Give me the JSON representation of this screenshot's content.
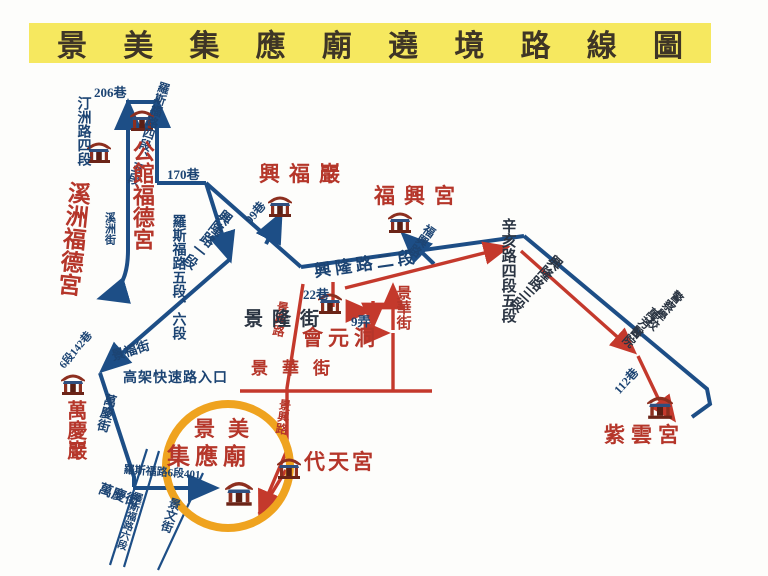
{
  "title": {
    "text": "景美集應廟遶境路線圖"
  },
  "colors": {
    "banner_bg": "#f6e85f",
    "banner_text": "#3e3526",
    "route_blue": "#1d4e86",
    "route_red": "#c4392c",
    "label_navy": "#1c4473",
    "label_dark": "#2a3442",
    "temple_red": "#b5362a",
    "highlight_orange": "#efa31f"
  },
  "highlight_circle": {
    "cx": 228,
    "cy": 466,
    "r": 62
  },
  "temples": [
    {
      "name": "公館福德宮",
      "icon": {
        "x": 129,
        "y": 108,
        "size": 26
      },
      "labels": [
        {
          "text": "公館福德宮",
          "x": 130,
          "y": 140,
          "size": 22,
          "vertical": true
        }
      ]
    },
    {
      "name": "溪洲福德宮",
      "icon": {
        "x": 86,
        "y": 140,
        "size": 26
      },
      "labels": [
        {
          "text": "溪洲福德宮",
          "x": 66,
          "y": 180,
          "size": 23,
          "vertical": true,
          "rotate": 6
        }
      ]
    },
    {
      "name": "興福巖",
      "icon": {
        "x": 267,
        "y": 194,
        "size": 26
      },
      "labels": [
        {
          "text": "興福巖",
          "x": 259,
          "y": 164,
          "size": 21,
          "ls": 9
        }
      ]
    },
    {
      "name": "福興宮",
      "icon": {
        "x": 387,
        "y": 210,
        "size": 26
      },
      "labels": [
        {
          "text": "福興宮",
          "x": 374,
          "y": 186,
          "size": 21,
          "ls": 9
        }
      ]
    },
    {
      "name": "會元洞",
      "icon": {
        "x": 317,
        "y": 291,
        "size": 26
      },
      "labels": [
        {
          "text": "會元洞",
          "x": 302,
          "y": 328,
          "size": 21,
          "ls": 5
        }
      ]
    },
    {
      "name": "萬慶巖",
      "icon": {
        "x": 60,
        "y": 372,
        "size": 26
      },
      "labels": [
        {
          "text": "萬慶巖",
          "x": 64,
          "y": 400,
          "size": 20,
          "vertical": true
        }
      ]
    },
    {
      "name": "紫雲宮",
      "icon": {
        "x": 646,
        "y": 394,
        "size": 28
      },
      "labels": [
        {
          "text": "紫雲宮",
          "x": 604,
          "y": 425,
          "size": 21,
          "ls": 6
        }
      ]
    },
    {
      "name": "代天宮",
      "icon": {
        "x": 276,
        "y": 456,
        "size": 26
      },
      "labels": [
        {
          "text": "代天宮",
          "x": 304,
          "y": 452,
          "size": 21,
          "ls": 3
        }
      ]
    },
    {
      "name": "景美集應廟",
      "icon": {
        "x": 224,
        "y": 479,
        "size": 30
      },
      "labels": [
        {
          "text": "景美",
          "x": 194,
          "y": 419,
          "size": 21,
          "ls": 13
        },
        {
          "text": "集應廟",
          "x": 167,
          "y": 445,
          "size": 23,
          "ls": 5
        }
      ]
    }
  ],
  "road_labels": [
    {
      "text": "206巷",
      "x": 94,
      "y": 86,
      "size": 13
    },
    {
      "text": "汀洲路四段",
      "x": 75,
      "y": 96,
      "size": 14,
      "vertical": true
    },
    {
      "text": "羅斯福路四段、五段",
      "x": 159,
      "y": 80,
      "size": 12,
      "vertical": true,
      "rotate": 18
    },
    {
      "text": "170巷",
      "x": 167,
      "y": 168,
      "size": 13
    },
    {
      "text": "溪洲街",
      "x": 103,
      "y": 212,
      "size": 11,
      "vertical": true
    },
    {
      "text": "羅斯福路五段、六段",
      "x": 170,
      "y": 214,
      "size": 14,
      "vertical": true
    },
    {
      "text": "興隆路一段",
      "x": 222,
      "y": 206,
      "size": 14,
      "vertical": true,
      "rotate": 38
    },
    {
      "text": "99巷",
      "x": 243,
      "y": 218,
      "size": 12,
      "rotate": -50
    },
    {
      "text": "興隆路二段",
      "x": 313,
      "y": 263,
      "size": 17,
      "ls": 4,
      "rotate": -8
    },
    {
      "text": "福興路",
      "x": 427,
      "y": 222,
      "size": 12,
      "vertical": true,
      "rotate": 35
    },
    {
      "text": "辛亥路四段五段",
      "x": 499,
      "y": 218,
      "size": 15,
      "vertical": true,
      "color": "dark"
    },
    {
      "text": "興隆路三段",
      "x": 553,
      "y": 251,
      "size": 14,
      "vertical": true,
      "rotate": 42,
      "color": "dark"
    },
    {
      "text": "警察學校",
      "x": 676,
      "y": 288,
      "size": 12,
      "vertical": true,
      "rotate": 42,
      "wrap": 2,
      "color": "dark"
    },
    {
      "text": "萬芳醫院",
      "x": 652,
      "y": 305,
      "size": 12,
      "vertical": true,
      "rotate": 42,
      "wrap": 2,
      "color": "dark"
    },
    {
      "text": "112巷",
      "x": 612,
      "y": 388,
      "size": 12,
      "rotate": -48
    },
    {
      "text": "22巷",
      "x": 303,
      "y": 288,
      "size": 13
    },
    {
      "text": "9弄",
      "x": 351,
      "y": 315,
      "size": 13
    },
    {
      "text": "景華街",
      "x": 394,
      "y": 285,
      "size": 15,
      "vertical": true,
      "color": "red"
    },
    {
      "text": "景華街",
      "x": 251,
      "y": 360,
      "size": 17,
      "ls": 14,
      "color": "red"
    },
    {
      "text": "景興路",
      "x": 277,
      "y": 300,
      "size": 12,
      "vertical": true,
      "rotate": 10,
      "color": "red"
    },
    {
      "text": "景興路",
      "x": 279,
      "y": 398,
      "size": 12,
      "vertical": true,
      "rotate": 8,
      "color": "red"
    },
    {
      "text": "景隆街",
      "x": 244,
      "y": 310,
      "size": 19,
      "ls": 9,
      "color": "dark"
    },
    {
      "text": "景福街",
      "x": 110,
      "y": 350,
      "size": 13,
      "rotate": -17
    },
    {
      "text": "6段142巷",
      "x": 58,
      "y": 364,
      "size": 11,
      "rotate": -50
    },
    {
      "text": "高架快速路入口",
      "x": 123,
      "y": 372,
      "size": 14,
      "ls": 1
    },
    {
      "text": "萬慶街",
      "x": 104,
      "y": 392,
      "size": 13,
      "vertical": true,
      "rotate": 14
    },
    {
      "text": "萬慶街",
      "x": 101,
      "y": 483,
      "size": 14,
      "rotate": 20
    },
    {
      "text": "羅斯福路6段401",
      "x": 124,
      "y": 465,
      "size": 11,
      "rotate": 4
    },
    {
      "text": "羅斯福路六段",
      "x": 132,
      "y": 490,
      "size": 10,
      "vertical": true,
      "rotate": 18
    },
    {
      "text": "景文街",
      "x": 170,
      "y": 496,
      "size": 12,
      "vertical": true,
      "rotate": 18
    }
  ]
}
